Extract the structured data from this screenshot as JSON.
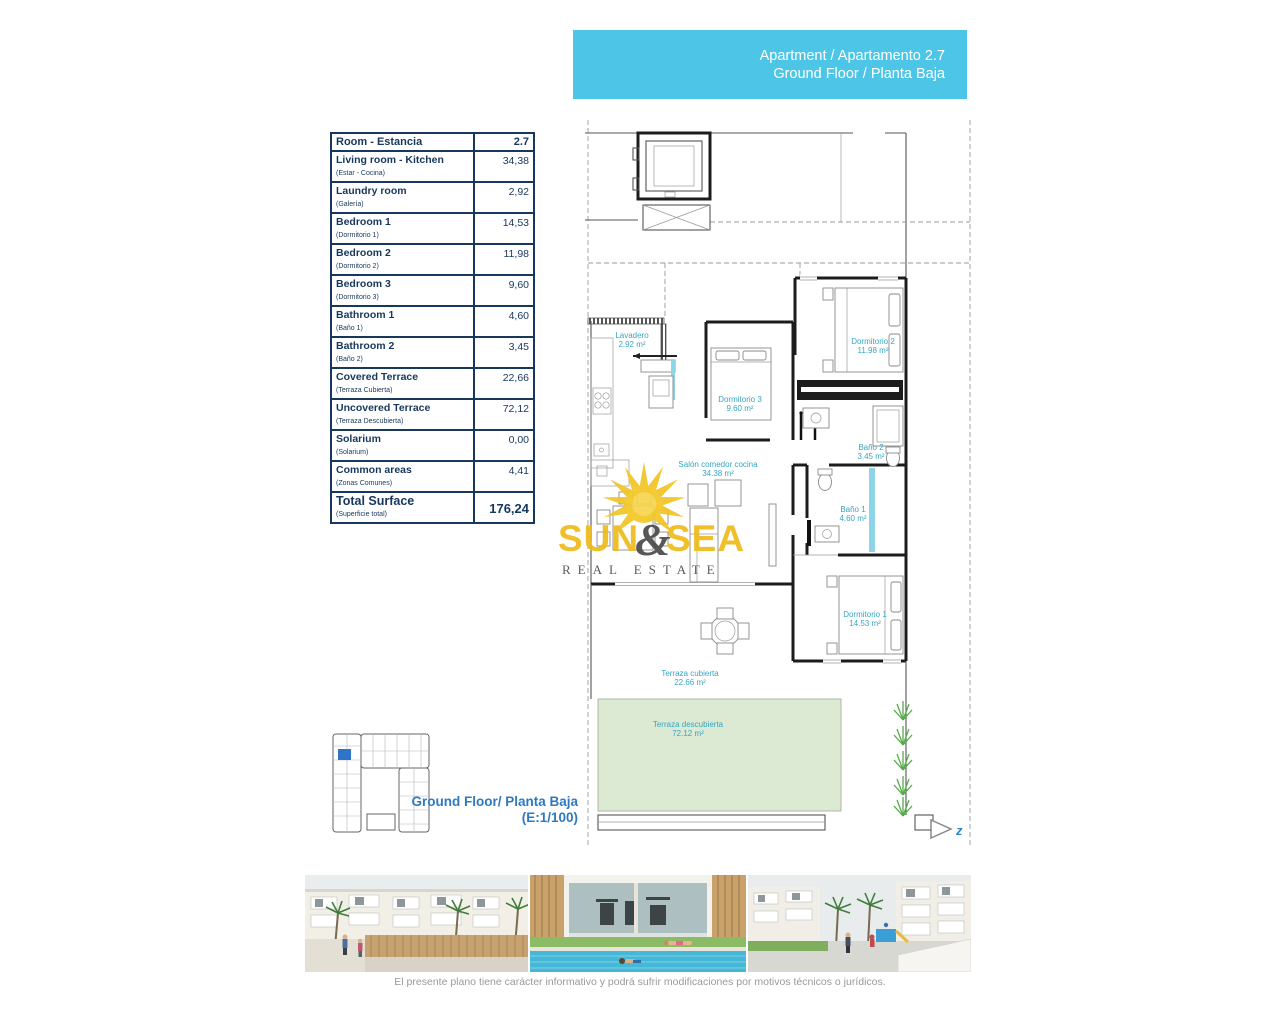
{
  "banner": {
    "line1": "Apartment / Apartamento 2.7",
    "line2": "Ground Floor / Planta Baja",
    "bg_color": "#4dc5e6"
  },
  "table": {
    "header": {
      "label": "Room - Estancia",
      "value": "2.7"
    },
    "rows": [
      {
        "en": "Living room - Kitchen",
        "es": "(Estar - Cocina)",
        "value": "34,38"
      },
      {
        "en": "Laundry room",
        "es": "(Galería)",
        "value": "2,92"
      },
      {
        "en": "Bedroom 1",
        "es": "(Dormitorio 1)",
        "value": "14,53"
      },
      {
        "en": "Bedroom 2",
        "es": "(Dormitorio 2)",
        "value": "11,98"
      },
      {
        "en": "Bedroom 3",
        "es": "(Dormitorio 3)",
        "value": "9,60"
      },
      {
        "en": "Bathroom 1",
        "es": "(Baño 1)",
        "value": "4,60"
      },
      {
        "en": "Bathroom 2",
        "es": "(Baño 2)",
        "value": "3,45"
      },
      {
        "en": "Covered Terrace",
        "es": "(Terraza Cubierta)",
        "value": "22,66"
      },
      {
        "en": "Uncovered Terrace",
        "es": "(Terraza Descubierta)",
        "value": "72,12"
      },
      {
        "en": "Solarium",
        "es": "(Solarium)",
        "value": "0,00"
      },
      {
        "en": "Common areas",
        "es": "(Zonas Comunes)",
        "value": "4,41"
      }
    ],
    "total": {
      "en": "Total Surface",
      "es": "(Superficie total)",
      "value": "176,24"
    }
  },
  "plan": {
    "rooms": [
      {
        "name": "Lavadero",
        "area": "2.92 m²"
      },
      {
        "name": "Dormitorio 3",
        "area": "9.60 m²"
      },
      {
        "name": "Dormitorio 2",
        "area": "11.98 m²"
      },
      {
        "name": "Baño 2",
        "area": "3.45 m²"
      },
      {
        "name": "Salón comedor cocina",
        "area": "34.38 m²"
      },
      {
        "name": "Baño 1",
        "area": "4.60 m²"
      },
      {
        "name": "Dormitorio 1",
        "area": "14.53 m²"
      },
      {
        "name": "Terraza cubierta",
        "area": "22.66 m²"
      },
      {
        "name": "Terraza descubierta",
        "area": "72.12 m²"
      }
    ],
    "north_label": "z",
    "label_color": "#35a5c5",
    "terrace_fill": "#dcead3"
  },
  "logo": {
    "word1": "SUN",
    "amp": "&",
    "word2": "SEA",
    "tagline": "REAL ESTATE",
    "yellow": "#eebc1d",
    "gray": "#4c4c4c"
  },
  "footer": {
    "floor_line1": "Ground Floor/ Planta Baja",
    "floor_line2": "(E:1/100)",
    "disclaimer": "El presente plano tiene carácter informativo y podrá sufrir modificaciones por motivos técnicos o jurídicos."
  }
}
